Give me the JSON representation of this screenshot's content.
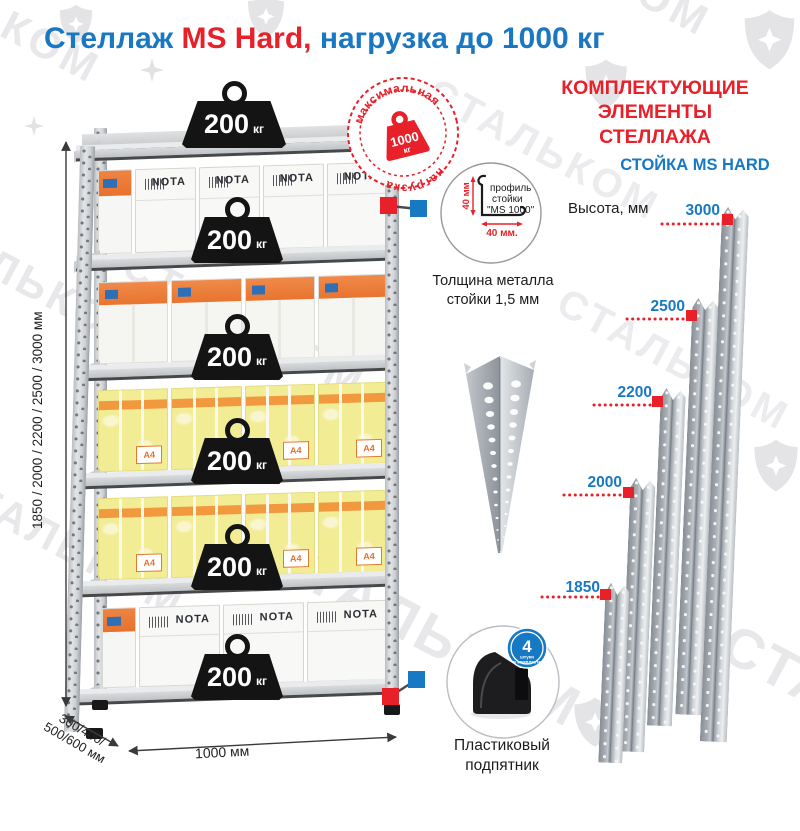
{
  "title": {
    "part1": "Стеллаж ",
    "part2": "MS Hard,",
    "part3": " нагрузка до 1000 кг"
  },
  "watermark": {
    "text": "СТАЛЬКОМ"
  },
  "rack": {
    "weight_value": "200",
    "weight_unit": "кг",
    "stamp": {
      "arc_top": "максимальная",
      "arc_bottom": "нагрузка",
      "value": "1000",
      "unit": "кг"
    },
    "box_brand": "NOTA",
    "box_label": "A4",
    "dim_height": "1850 / 2000 / 2200 / 2500 / 3000 мм",
    "dim_depth_line1": "300/400/",
    "dim_depth_line2": "500/600 мм",
    "dim_width": "1000 мм"
  },
  "profile": {
    "label_line1": "профиль",
    "label_line2": "стойки",
    "label_line3": "\"MS 1000\"",
    "dim_vertical": "40 мм",
    "dim_horizontal": "40 мм.",
    "caption_line1": "Толщина металла",
    "caption_line2": "стойки 1,5 мм"
  },
  "foot": {
    "badge_value": "4",
    "badge_unit": "штуки",
    "badge_arc": "в комплекте",
    "caption_line1": "Пластиковый",
    "caption_line2": "подпятник"
  },
  "components": {
    "heading_line1": "КОМПЛЕКТУЮЩИЕ",
    "heading_line2": "ЭЛЕМЕНТЫ СТЕЛЛАЖА",
    "subheading": "СТОЙКА MS HARD",
    "axis_label": "Высота, мм",
    "posts": [
      {
        "height": "3000"
      },
      {
        "height": "2500"
      },
      {
        "height": "2200"
      },
      {
        "height": "2000"
      },
      {
        "height": "1850"
      }
    ]
  }
}
